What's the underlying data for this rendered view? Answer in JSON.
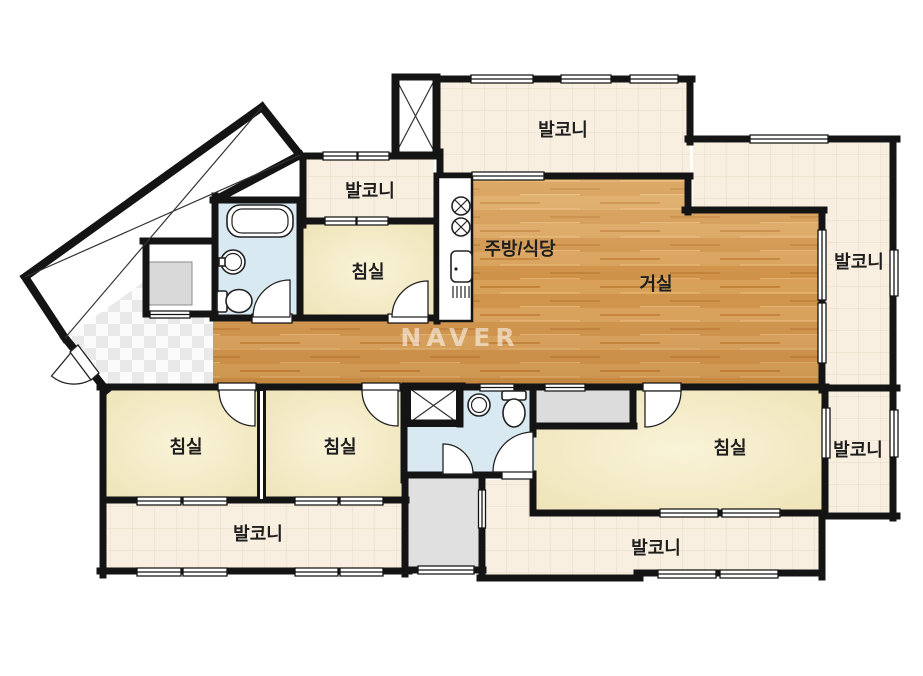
{
  "watermark": "NAVER",
  "labels": {
    "balcony_top": "발코니",
    "balcony_small": "발코니",
    "balcony_right_upper": "발코니",
    "balcony_right_lower": "발코니",
    "balcony_bottom_left": "발코니",
    "balcony_bottom": "발코니",
    "kitchen_dining": "주방/식당",
    "living_room": "거실",
    "bedroom_top": "침실",
    "bedroom_left": "침실",
    "bedroom_middle": "침실",
    "bedroom_right": "침실"
  },
  "colors": {
    "wall": "#141414",
    "balcony_tile": "#f9efe1",
    "tile_grid": "#e8dbc4",
    "bedroom": "#f3eac5",
    "wood": "#d49a52",
    "bathroom": "#d9e9f2",
    "gray_room": "#e0e0e0",
    "label_text": "#1e1e1e"
  }
}
